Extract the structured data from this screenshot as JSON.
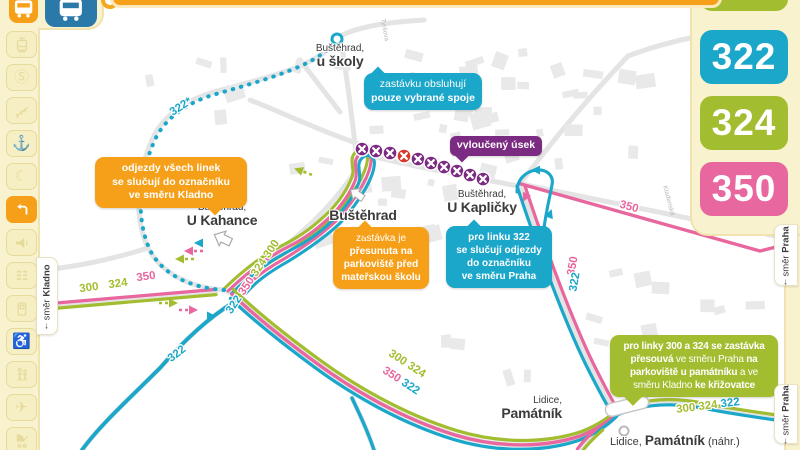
{
  "colors": {
    "cream": "#f9f2cf",
    "cream_border": "#f0e3af",
    "icon_faded": "#e7da9d",
    "icon_faded_bg": "#f6efc3",
    "orange": "#f6a01a",
    "blue": "#2b79a8",
    "green": "#a2bd2f",
    "pink": "#e8679e",
    "cyan": "#1ba7c9",
    "purple": "#7c2b82",
    "red": "#d93a2b",
    "street": "#e4e4e4",
    "building": "#e9e9e9",
    "label": "#3b3b3b"
  },
  "top_icons": [
    {
      "name": "bus-regional",
      "color_key": "orange"
    },
    {
      "name": "bus-city",
      "color_key": "blue"
    }
  ],
  "sidebar": {
    "items": [
      {
        "name": "tram",
        "glyph": "svg:tram"
      },
      {
        "name": "s-train",
        "glyph": "char:Ⓢ"
      },
      {
        "name": "funicular",
        "glyph": "svg:funicular"
      },
      {
        "name": "boat",
        "glyph": "char:⚓"
      },
      {
        "name": "night-service",
        "glyph": "char:☾"
      },
      {
        "name": "detour",
        "glyph": "svg:detour",
        "active": true
      },
      {
        "name": "announcement",
        "glyph": "svg:announce"
      },
      {
        "name": "timetable",
        "glyph": "svg:timetable"
      },
      {
        "name": "ticket",
        "glyph": "svg:ticket"
      },
      {
        "name": "wheelchair",
        "glyph": "char:♿"
      },
      {
        "name": "family",
        "glyph": "svg:family"
      },
      {
        "name": "airport",
        "glyph": "char:✈"
      },
      {
        "name": "stroller",
        "glyph": "svg:stroller"
      }
    ]
  },
  "right_badges": [
    {
      "line": "300",
      "color_key": "green"
    },
    {
      "line": "322",
      "color_key": "cyan"
    },
    {
      "line": "324",
      "color_key": "green"
    },
    {
      "line": "350",
      "color_key": "pink"
    }
  ],
  "direction_tabs": {
    "kladno": {
      "arrow": "↓",
      "word": "směr",
      "city": "Kladno"
    },
    "praha_top": {
      "arrow": "↓",
      "word": "směr",
      "city": "Praha"
    },
    "praha_bottom": {
      "arrow": "↓",
      "word": "směr",
      "city": "Praha"
    }
  },
  "stops": {
    "uskoly": {
      "l1": "Buštěhrad,",
      "l2": "u školy"
    },
    "bustehrad": {
      "l2": "Buštěhrad"
    },
    "kahance": {
      "l1": "Buštěhrad,",
      "l2": "U Kahance"
    },
    "kaplicky": {
      "l1": "Buštěhrad,",
      "l2": "U Kapličky"
    },
    "lidice": {
      "l1": "Lidice,",
      "l2": "Památník"
    },
    "lidice_nahr": {
      "lines": [
        [
          {
            "t": "Lidice, ",
            "b": false
          },
          {
            "t": "Památník",
            "b": true
          },
          {
            "t": " (náhr.)",
            "b": false
          }
        ]
      ]
    }
  },
  "callouts": {
    "odjezdy": {
      "color_key": "orange",
      "lines": [
        [
          {
            "t": "odjezdy všech linek",
            "b": true
          }
        ],
        [
          {
            "t": "se slučují do označníku",
            "b": true
          }
        ],
        [
          {
            "t": "ve směru Kladno",
            "b": true
          }
        ]
      ]
    },
    "uskoly": {
      "color_key": "cyan",
      "lines": [
        [
          {
            "t": "zastávku obsluhují",
            "b": false
          }
        ],
        [
          {
            "t": "pouze vybrané spoje",
            "b": true
          }
        ]
      ]
    },
    "vylouceny": {
      "color_key": "purple",
      "lines": [
        [
          {
            "t": "vyloučený úsek",
            "b": true
          }
        ]
      ]
    },
    "presunuta": {
      "color_key": "orange",
      "lines": [
        [
          {
            "t": "zastávka je",
            "b": false
          }
        ],
        [
          {
            "t": "přesunuta na",
            "b": true
          }
        ],
        [
          {
            "t": "parkoviště před",
            "b": true
          }
        ],
        [
          {
            "t": "mateřskou školu",
            "b": true
          }
        ]
      ]
    },
    "linka322": {
      "color_key": "cyan",
      "lines": [
        [
          {
            "t": "pro linku 322",
            "b": true
          }
        ],
        [
          {
            "t": "se slučují odjezdy",
            "b": true
          }
        ],
        [
          {
            "t": "do označníku",
            "b": true
          }
        ],
        [
          {
            "t": "ve směru Praha",
            "b": true
          }
        ]
      ]
    },
    "linky300324": {
      "color_key": "green",
      "lines": [
        [
          {
            "t": "pro linky 300 a 324 se zastávka",
            "b": true
          }
        ],
        [
          {
            "t": "přesouvá",
            "b": true
          },
          {
            "t": " ve směru Praha ",
            "b": false
          },
          {
            "t": "na",
            "b": true
          }
        ],
        [
          {
            "t": "parkoviště u památníku",
            "b": true
          },
          {
            "t": " a ve",
            "b": false
          }
        ],
        [
          {
            "t": "směru Kladno ",
            "b": false
          },
          {
            "t": "ke křižovatce",
            "b": true
          }
        ]
      ]
    }
  },
  "route_labels": [
    {
      "parts": [
        {
          "t": "322*",
          "c": "cyan"
        }
      ]
    },
    {
      "parts": [
        {
          "t": "300",
          "c": "green"
        }
      ]
    },
    {
      "parts": [
        {
          "t": "324",
          "c": "green"
        }
      ]
    },
    {
      "parts": [
        {
          "t": "350",
          "c": "pink"
        }
      ]
    },
    {
      "parts": [
        {
          "t": "322 ",
          "c": "cyan"
        },
        {
          "t": "350 ",
          "c": "pink"
        },
        {
          "t": "324 ",
          "c": "green"
        },
        {
          "t": "300",
          "c": "green"
        }
      ]
    },
    {
      "parts": [
        {
          "t": "300 324",
          "c": "green"
        }
      ]
    },
    {
      "parts": [
        {
          "t": "350 ",
          "c": "pink"
        },
        {
          "t": "322",
          "c": "cyan"
        }
      ]
    },
    {
      "parts": [
        {
          "t": "350",
          "c": "pink"
        }
      ]
    },
    {
      "parts": [
        {
          "t": "350",
          "c": "pink"
        }
      ]
    },
    {
      "parts": [
        {
          "t": "322",
          "c": "cyan"
        }
      ]
    },
    {
      "parts": [
        {
          "t": "322",
          "c": "cyan"
        }
      ]
    },
    {
      "parts": [
        {
          "t": "300 324 ",
          "c": "green"
        },
        {
          "t": "322",
          "c": "cyan"
        }
      ]
    }
  ],
  "excluded_section": {
    "marker_count": 10,
    "red_marker_index": 3
  },
  "street_labels": [
    {
      "t": "Tyršova"
    },
    {
      "t": "Kladenská"
    }
  ]
}
